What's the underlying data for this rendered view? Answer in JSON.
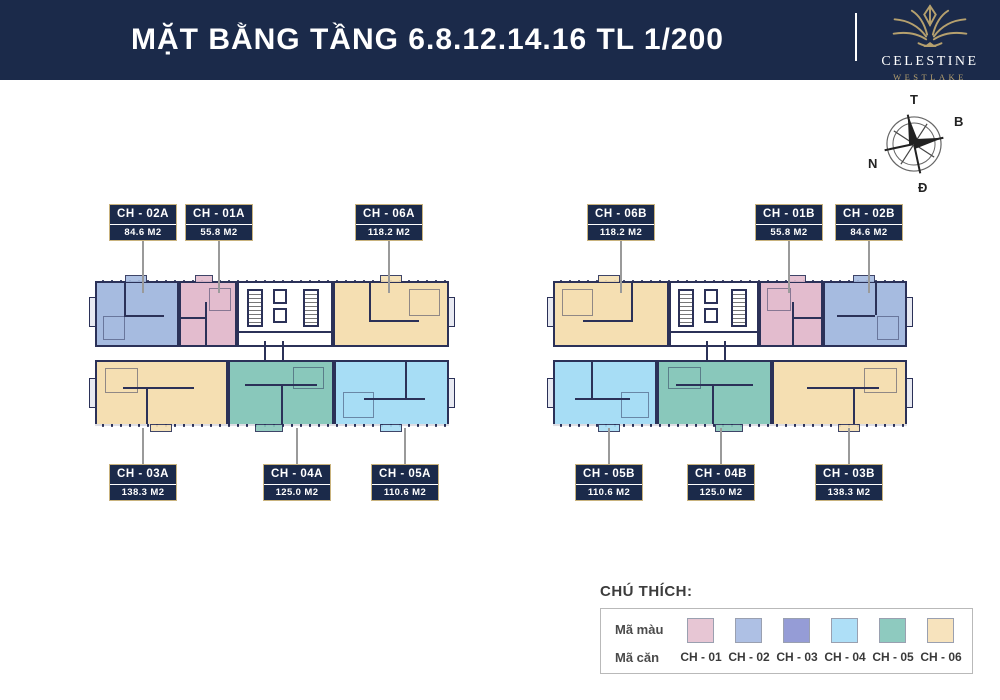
{
  "header": {
    "title": "MẶT BẰNG TẦNG 6.8.12.14.16 TL 1/200",
    "brand_name": "CELESTINE",
    "brand_sub": "WESTLAKE"
  },
  "compass": {
    "top": "T",
    "right": "B",
    "left": "N",
    "bottom": "Đ"
  },
  "colors": {
    "header_bg": "#1b2a4a",
    "gold": "#b5a06e",
    "tag_border": "#c9b37e",
    "wall": "#2b3158",
    "leader": "#9a9a9a",
    "units": {
      "ch01": "#e3bcce",
      "ch02": "#a6bbe0",
      "ch03": "#8a92cd",
      "ch04": "#a7ddf5",
      "ch05": "#89c8bb",
      "ch06": "#f5dfb2"
    }
  },
  "blocks": {
    "a": {
      "top": [
        {
          "code": "CH - 02A",
          "area": "84.6 M2"
        },
        {
          "code": "CH - 01A",
          "area": "55.8 M2"
        },
        {
          "code": "CH - 06A",
          "area": "118.2 M2"
        }
      ],
      "bottom": [
        {
          "code": "CH - 03A",
          "area": "138.3 M2"
        },
        {
          "code": "CH - 04A",
          "area": "125.0 M2"
        },
        {
          "code": "CH - 05A",
          "area": "110.6 M2"
        }
      ]
    },
    "b": {
      "top": [
        {
          "code": "CH - 06B",
          "area": "118.2 M2"
        },
        {
          "code": "CH - 01B",
          "area": "55.8 M2"
        },
        {
          "code": "CH - 02B",
          "area": "84.6 M2"
        }
      ],
      "bottom": [
        {
          "code": "CH - 05B",
          "area": "110.6 M2"
        },
        {
          "code": "CH - 04B",
          "area": "125.0 M2"
        },
        {
          "code": "CH - 03B",
          "area": "138.3 M2"
        }
      ]
    }
  },
  "legend": {
    "title": "CHÚ THÍCH:",
    "color_row_label": "Mã màu",
    "unit_row_label": "Mã căn",
    "items": [
      {
        "code": "CH - 01",
        "color": "#e7c6d4"
      },
      {
        "code": "CH - 02",
        "color": "#aec0e4"
      },
      {
        "code": "CH - 03",
        "color": "#959cd6"
      },
      {
        "code": "CH - 04",
        "color": "#aedff7"
      },
      {
        "code": "CH - 05",
        "color": "#8ecabf"
      },
      {
        "code": "CH - 06",
        "color": "#f7e3bd"
      }
    ]
  }
}
